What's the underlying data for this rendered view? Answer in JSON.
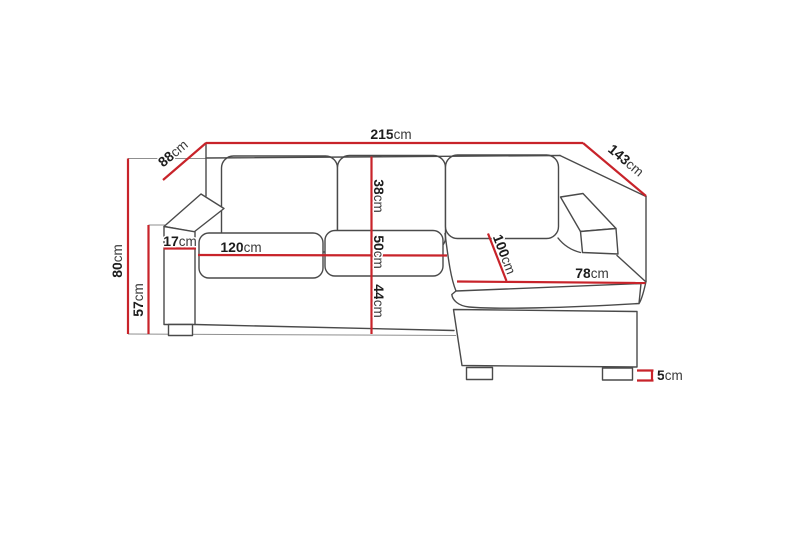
{
  "colors": {
    "dim": "#c8232a",
    "outline": "#4a4a4a",
    "extension": "#8f8f8f",
    "text": "#1c1c1c"
  },
  "diagram": {
    "name": "Corner sofa dimension drawing",
    "unit": "cm",
    "dims": {
      "width_total": {
        "num": "215",
        "unit": "cm",
        "value": 215
      },
      "depth_left": {
        "num": "88",
        "unit": "cm",
        "value": 88
      },
      "depth_right": {
        "num": "143",
        "unit": "cm",
        "value": 143
      },
      "height_total": {
        "num": "80",
        "unit": "cm",
        "value": 80
      },
      "armrest_height": {
        "num": "57",
        "unit": "cm",
        "value": 57
      },
      "armrest_width": {
        "num": "17",
        "unit": "cm",
        "value": 17
      },
      "seat_width": {
        "num": "120",
        "unit": "cm",
        "value": 120
      },
      "backrest_height": {
        "num": "38",
        "unit": "cm",
        "value": 38
      },
      "seat_depth": {
        "num": "50",
        "unit": "cm",
        "value": 50
      },
      "seat_height": {
        "num": "44",
        "unit": "cm",
        "value": 44
      },
      "chaise_length": {
        "num": "100",
        "unit": "cm",
        "value": 100
      },
      "chaise_width": {
        "num": "78",
        "unit": "cm",
        "value": 78
      },
      "leg_height": {
        "num": "5",
        "unit": "cm",
        "value": 5
      }
    }
  }
}
